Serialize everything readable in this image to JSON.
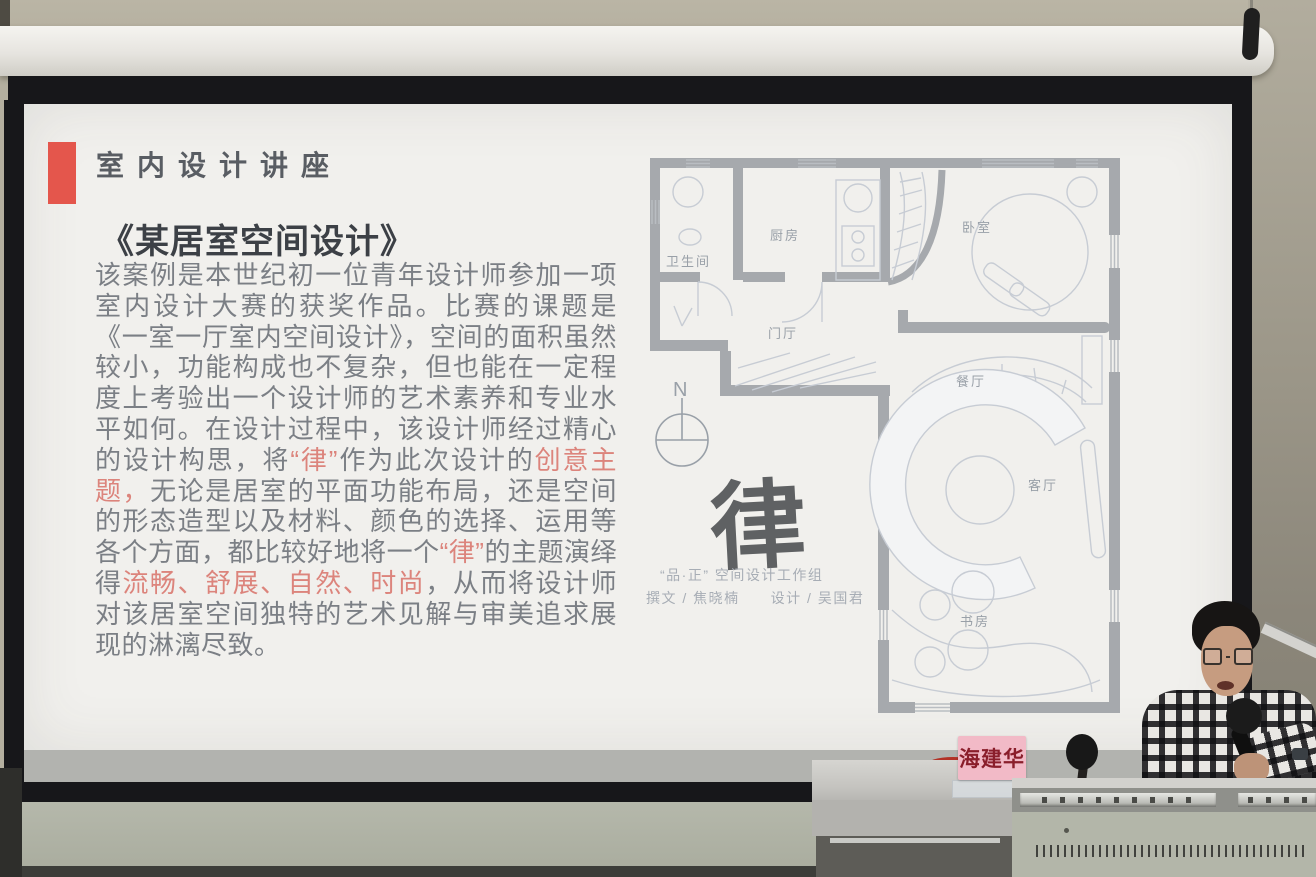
{
  "scene": {
    "description": "Lecture-hall photograph: wall-mounted projection screen showing an interior-design slide; lecturer with microphone seated at a metal podium",
    "colors": {
      "wall_beige": "#b4af9f",
      "screen_border_black": "#17171a",
      "slide_background": "#f1f0ed",
      "accent_red_bar": "#e4564c",
      "body_text_gray": "#7b7f85",
      "highlight_red": "#dc847c",
      "plan_wall_gray": "#a6a9ad",
      "desk_green_gray": "#b3b6a9",
      "name_plate_pink": "#f2bac7",
      "name_plate_text": "#8a1e2b"
    }
  },
  "slide": {
    "kicker": "室内设计讲座",
    "title": "《某居室空间设计》",
    "body_segments": [
      {
        "text": "该案例是本世纪初一位青年设计师参加一项室内设计大赛的获奖作品。比赛的课题是《一室一厅室内空间设计》，空间的面积虽然较小，功能构成也不复杂，但也能在一定程度上考验出一个设计师的艺术素养和专业水平如何。在设计过程中，该设计师经过精心的设计构思，将",
        "red": false
      },
      {
        "text": "“律”",
        "red": true
      },
      {
        "text": "作为此次设计的",
        "red": false
      },
      {
        "text": "创意主题，",
        "red": true
      },
      {
        "text": "无论是居室的平面功能布局，还是空间的形态造型以及材料、颜色的选择、运用等各个方面，都比较好地将一个",
        "red": false
      },
      {
        "text": "“律”",
        "red": true
      },
      {
        "text": "的主题演绎得",
        "red": false
      },
      {
        "text": "流畅、舒展、自然、时尚",
        "red": true
      },
      {
        "text": "，从而将设计师对该居室空间独特的艺术见解与审美追求展现的淋漓尽致。",
        "red": false
      }
    ]
  },
  "floor_plan": {
    "rooms": {
      "bathroom": "卫生间",
      "kitchen": "厨房",
      "bedroom": "卧室",
      "foyer": "门厅",
      "dining": "餐厅",
      "living": "客厅",
      "study": "书房"
    },
    "compass": "N",
    "calligraphy": "律",
    "studio": "“品·正” 空间设计工作组",
    "credits": "撰文 / 焦晓楠　　设计 / 吴国君"
  },
  "podium": {
    "name_plate": "海建华"
  }
}
